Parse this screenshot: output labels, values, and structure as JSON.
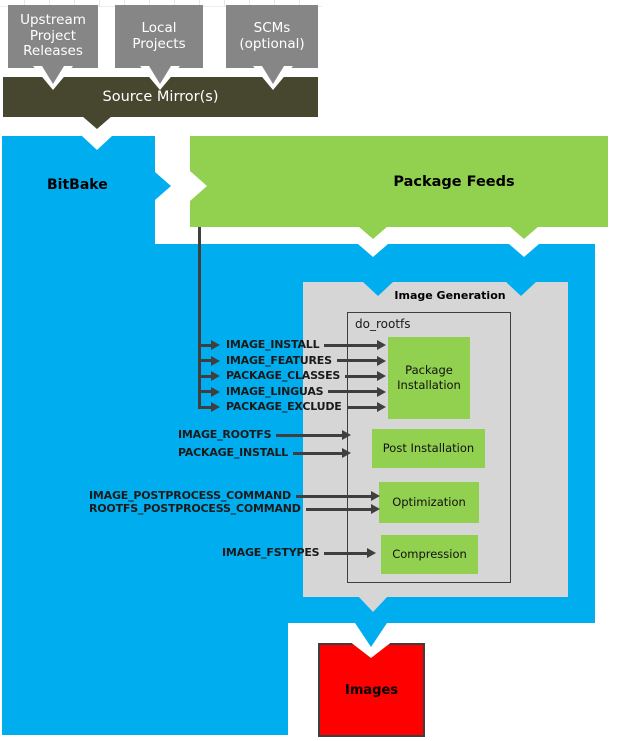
{
  "colors": {
    "cyan": "#00aeef",
    "green": "#92d050",
    "graybox": "#d6d6d6",
    "srcgray": "#868686",
    "olive": "#47462e",
    "red": "#fe0000",
    "ink": "#3f3f3f"
  },
  "source_flow": {
    "boxes": [
      {
        "label": "Upstream Project Releases"
      },
      {
        "label": "Local Projects"
      },
      {
        "label": "SCMs (optional)"
      }
    ],
    "mirror_label": "Source Mirror(s)"
  },
  "bitbake": {
    "label": "BitBake"
  },
  "package_feeds": {
    "label": "Package Feeds"
  },
  "image_generation": {
    "title": "Image Generation",
    "task_label": "do_rootfs",
    "steps": [
      {
        "label": "Package Installation"
      },
      {
        "label": "Post Installation"
      },
      {
        "label": "Optimization"
      },
      {
        "label": "Compression"
      }
    ]
  },
  "variables": {
    "package_installation": [
      "IMAGE_INSTALL",
      "IMAGE_FEATURES",
      "PACKAGE_CLASSES",
      "IMAGE_LINGUAS",
      "PACKAGE_EXCLUDE"
    ],
    "post_installation": [
      "IMAGE_ROOTFS",
      "PACKAGE_INSTALL"
    ],
    "optimization": [
      "IMAGE_POSTPROCESS_COMMAND",
      "ROOTFS_POSTPROCESS_COMMAND"
    ],
    "compression": [
      "IMAGE_FSTYPES"
    ]
  },
  "images": {
    "label": "Images"
  }
}
